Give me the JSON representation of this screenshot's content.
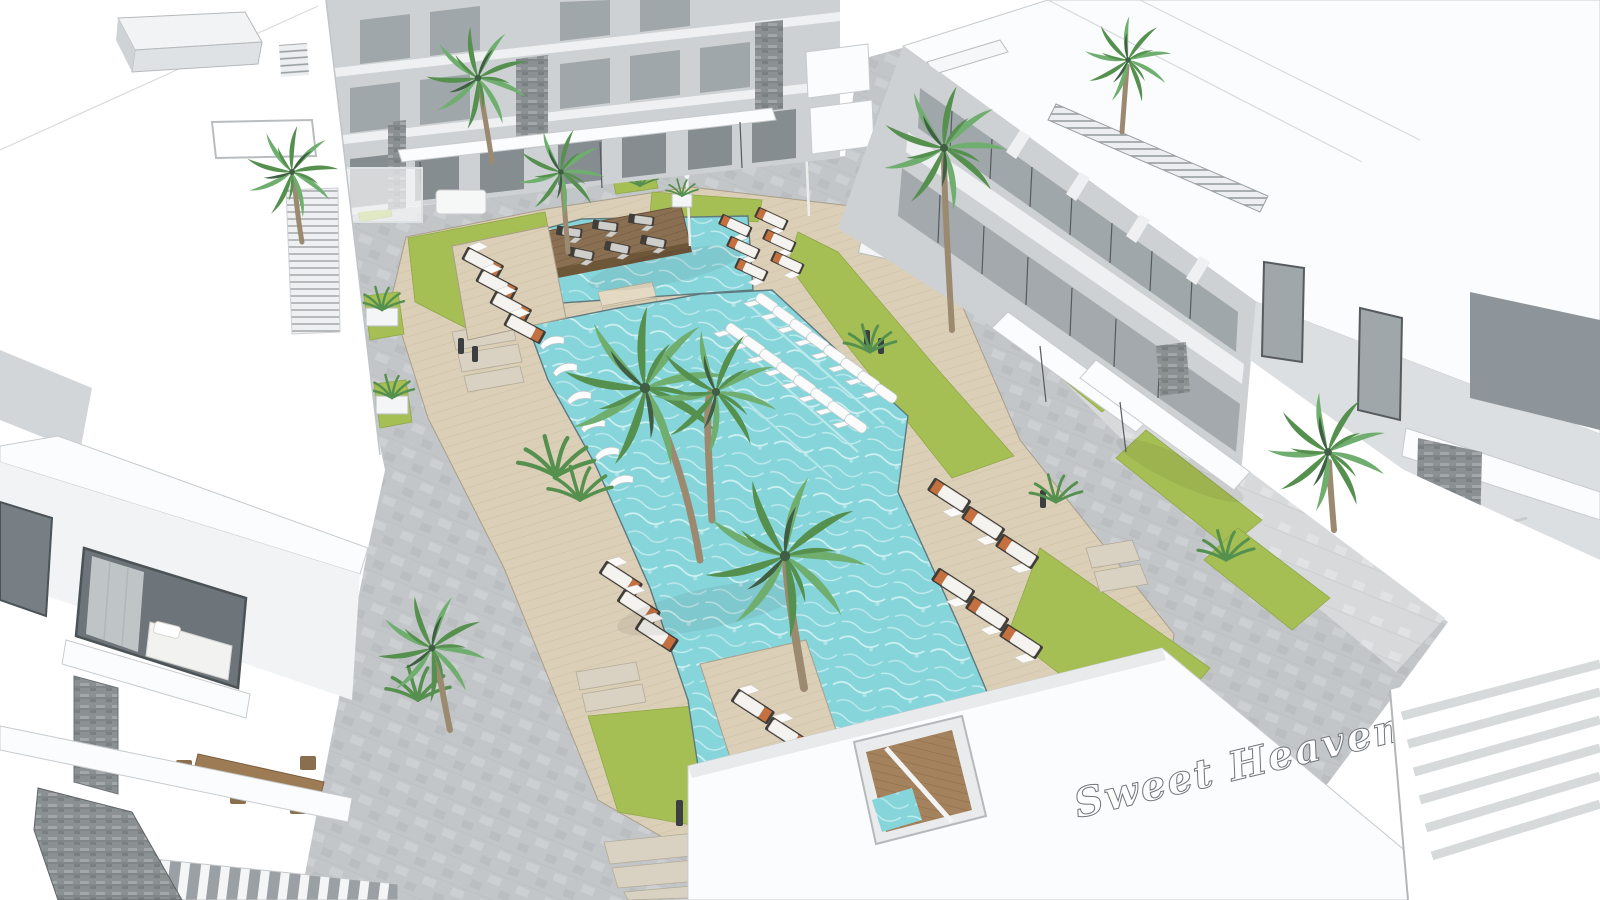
{
  "sign": {
    "text": "Sweet Heaven"
  },
  "colors": {
    "water": "#86d5db",
    "caustic": "#e2f7f8",
    "grass": "#a6bf55",
    "grass_dark": "#8fa845",
    "deck": "#dbcfb7",
    "deck_line": "#b7a98c",
    "wood_dark": "#8a6f52",
    "paver": "#c3c6c8",
    "paver_light": "#d7d9da",
    "edge": "#5f7a7e",
    "wall_white": "#fbfcfd",
    "wall_light": "#eef0f1",
    "facade_gray": "#cdd1d3",
    "glass": "#a0a7ab",
    "frame": "#565b5f",
    "stone": "#8b9093",
    "palm": "#6fae6e",
    "palm_dark": "#55904f",
    "trunk": "#9b8a70",
    "cushion": "#f5f3ef",
    "lounger_frame": "#413d39",
    "towel": "#c4703f",
    "flower": "#c0392b"
  }
}
